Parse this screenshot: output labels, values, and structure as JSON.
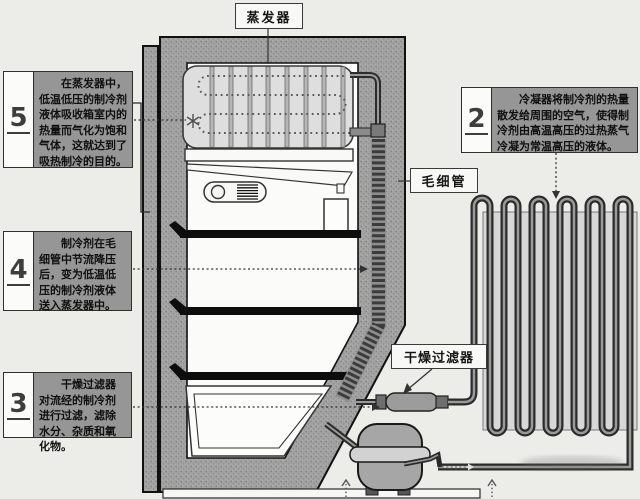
{
  "diagram_title": "冰箱制冷循环示意图",
  "labels": {
    "evaporator": "蒸发器",
    "capillary": "毛细管",
    "filter_drier": "干燥过滤器"
  },
  "callouts": [
    {
      "number": "5",
      "text": "在蒸发器中，低温低压的制冷剂液体吸收箱室内的热量而气化为饱和气体，这就达到了吸热制冷的目的。"
    },
    {
      "number": "4",
      "text": "制冷剂在毛细管中节流降压后，变为低温低压的制冷剂液体送入蒸发器中。"
    },
    {
      "number": "3",
      "text": "干燥过滤器对流经的制冷剂进行过滤，滤除水分、杂质和氧化物。"
    },
    {
      "number": "2",
      "text": "冷凝器将制冷剂的热量散发给周围的空气，使得制冷剂由高温高压的过热蒸气冷凝为常温高压的液体。"
    }
  ],
  "components": [
    "蒸发器",
    "毛细管",
    "干燥过滤器",
    "冷凝器",
    "压缩机"
  ],
  "colors": {
    "page_bg": "#ecece9",
    "wall_gray": "#a1a1a1",
    "callout_text_bg": "#969696",
    "interior_white": "#fbfbfa",
    "shelf_black": "#0d0d0d",
    "pipe_dark": "#2e2e2e",
    "pipe_core": "#9a9a9a",
    "condenser_panel": "#d7d7d7",
    "evaporator_fill": "#dedede"
  }
}
